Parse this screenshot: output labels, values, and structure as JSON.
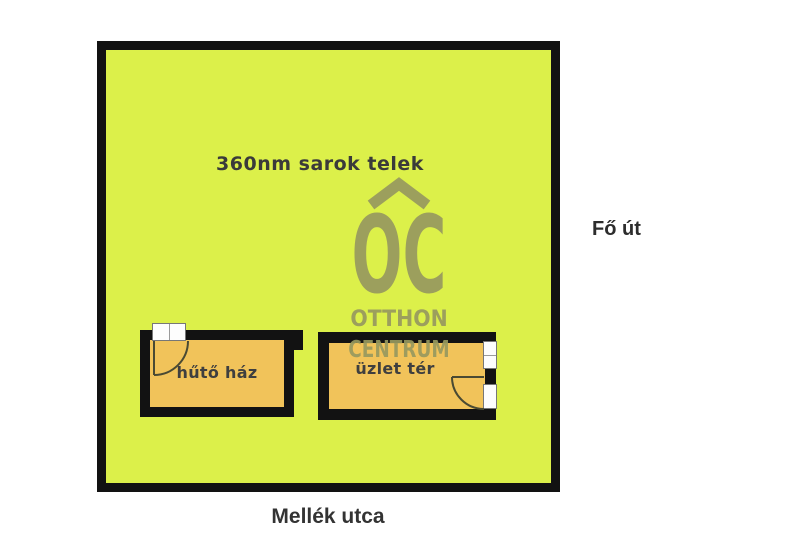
{
  "plot": {
    "area_label": "360nm sarok telek",
    "fill_color": "#dcf04a",
    "wall_color": "#121212"
  },
  "streets": {
    "right_label": "Fő út",
    "bottom_label": "Mellék utca"
  },
  "rooms": [
    {
      "label": "hűtő ház",
      "fill_color": "#f1c35a"
    },
    {
      "label": "üzlet tér",
      "fill_color": "#f1c35a"
    }
  ],
  "watermark": {
    "monogram": "OC",
    "line1": "OTTHON",
    "line2": "CENTRUM",
    "color": "#97995f"
  }
}
